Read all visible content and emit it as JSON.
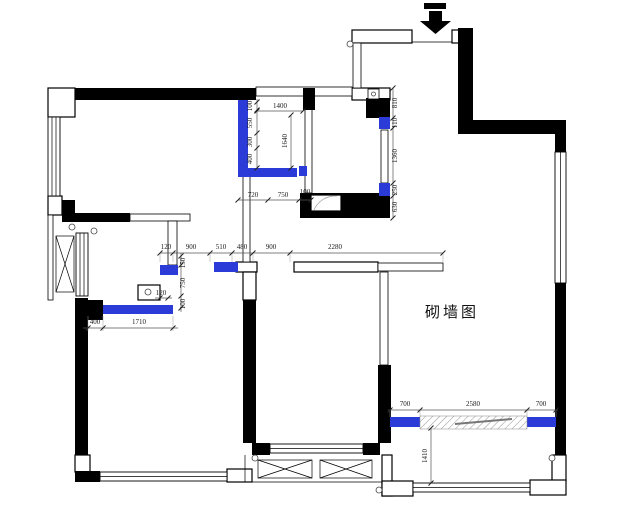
{
  "drawing": {
    "title": "砌墙图",
    "colors": {
      "wall": "#000000",
      "new_wall": "#2b3bd8",
      "dim_text": "#1a1a1a"
    },
    "dimensions": {
      "top_left_vertical": [
        "100",
        "550",
        "300",
        "400"
      ],
      "top_width": "1400",
      "top_inner_height": "1640",
      "top_bottom_chain": [
        "720",
        "750",
        "100"
      ],
      "right_vertical_chain": [
        "810",
        "110",
        "1360",
        "250",
        "630"
      ],
      "corridor_chain": [
        "120",
        "900",
        "510",
        "480",
        "900",
        "2280"
      ],
      "mid_left_vertical": [
        "150",
        "750",
        "100"
      ],
      "mid_left_offset": "120",
      "bottom_left_chain": [
        "400",
        "1710"
      ],
      "bottom_right_chain": [
        "700",
        "2580",
        "700"
      ],
      "balcony_height": "1410"
    }
  }
}
